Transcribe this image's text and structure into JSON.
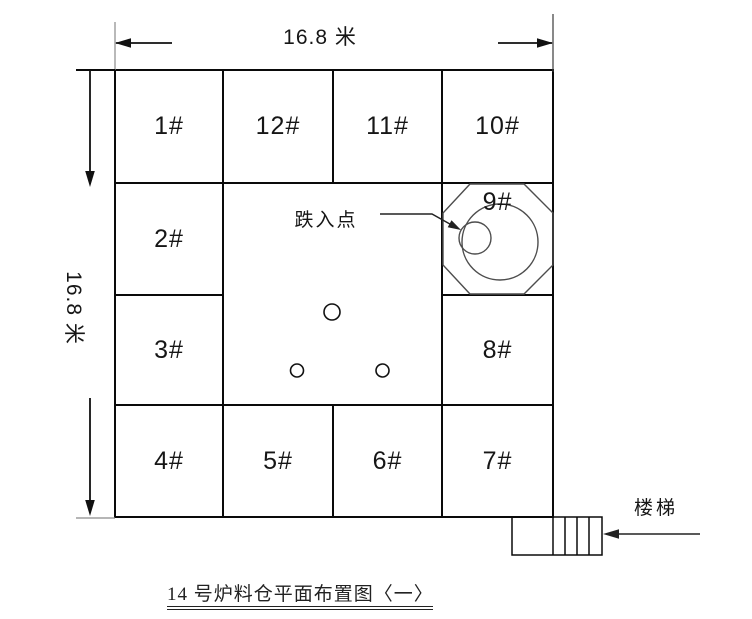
{
  "caption": "14 号炉料仓平面布置图〈一〉",
  "dimensions": {
    "top": "16.8 米",
    "left": "16.8 米"
  },
  "cells": [
    "1#",
    "2#",
    "3#",
    "4#",
    "5#",
    "6#",
    "7#",
    "8#",
    "9#",
    "10#",
    "11#",
    "12#"
  ],
  "annotations": {
    "drop_point": "跌入点",
    "stairs": "楼梯"
  },
  "colors": {
    "grid_line": "#0a0a0a",
    "thin_line": "#4d4d4d",
    "extension_tick": "#8a8a8a",
    "background": "#ffffff"
  }
}
